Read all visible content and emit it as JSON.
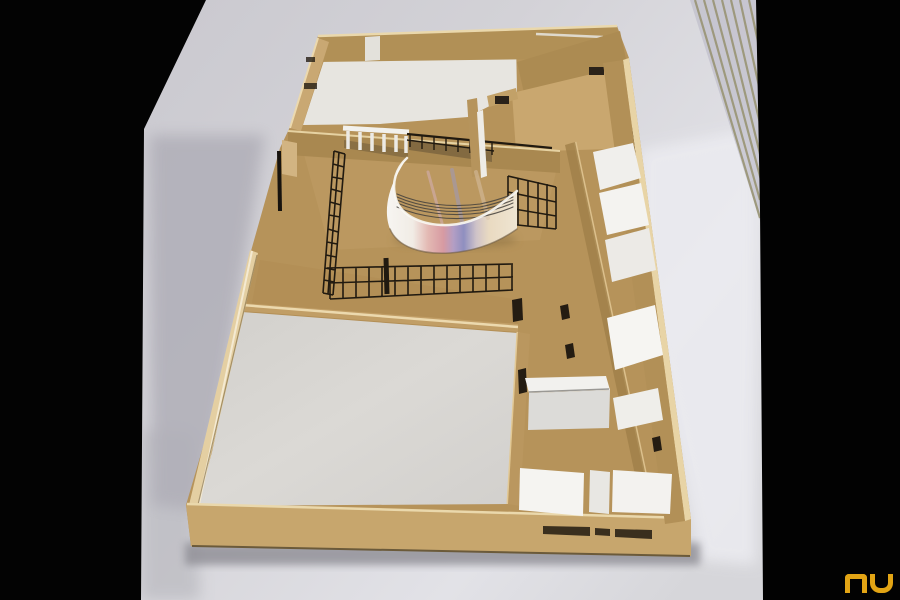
{
  "watermark": {
    "text": "NU"
  },
  "palette": {
    "letterbox": "#030303",
    "table_light": "#eaeaee",
    "table_mid": "#cfced4",
    "table_shadow": "#a9a8af",
    "mdf_floor": "#b6935a",
    "mdf_edge_light": "#ead8ac",
    "mdf_wall_shade": "#a5854e",
    "card_white": "#f2f1ed",
    "terrace_gray": "#d8d6d2",
    "grid_black": "#211a10",
    "ribbon_pink": "#d79aa2",
    "ribbon_violet": "#8f8fc0",
    "ribbon_cream": "#e9dac1",
    "logo_orange": "#e2a414"
  }
}
